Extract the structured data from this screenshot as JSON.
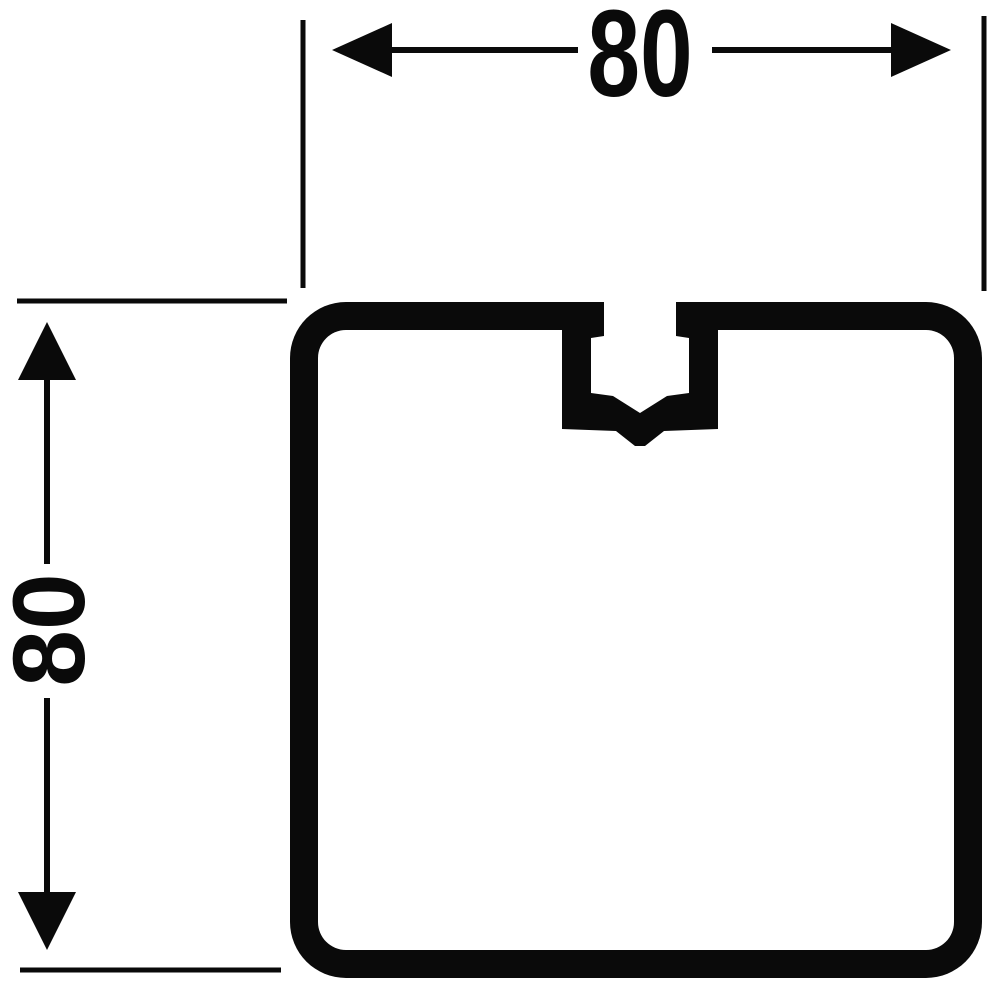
{
  "figure": {
    "kind": "profile-cross-section-drawing",
    "dimensions": {
      "width_label": "80",
      "height_label": "80"
    },
    "colors": {
      "ink": "#0a0a0a",
      "paper": "#ffffff"
    }
  }
}
